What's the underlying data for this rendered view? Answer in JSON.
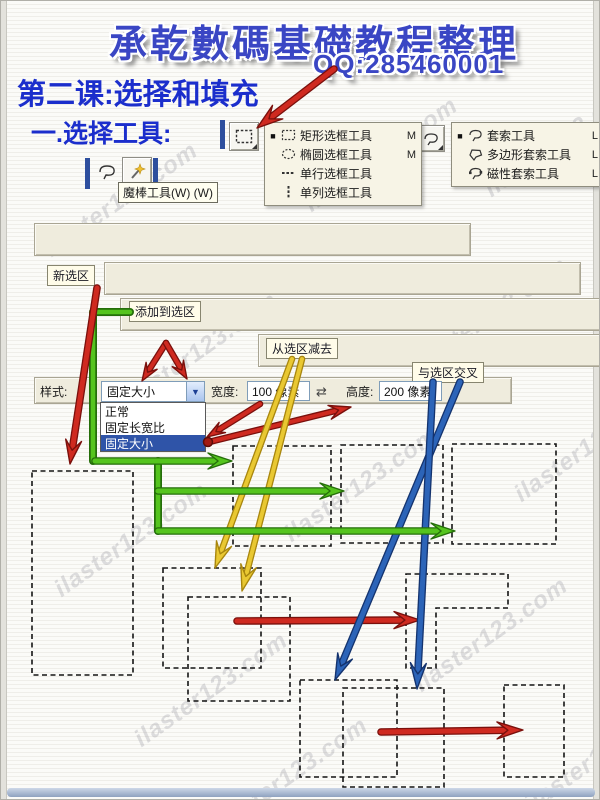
{
  "header": {
    "title": "承乾數碼基礎教程整理",
    "qq": "QQ:285460001"
  },
  "lesson": {
    "title": "第二课:选择和填充",
    "subtitle": "一.选择工具:"
  },
  "menus": {
    "marquee": {
      "items": [
        {
          "label": "矩形选框工具",
          "shortcut": "M",
          "icon": "rect-marquee-icon",
          "current": true
        },
        {
          "label": "椭圆选框工具",
          "shortcut": "M",
          "icon": "ellipse-marquee-icon",
          "current": false
        },
        {
          "label": "单行选框工具",
          "shortcut": "",
          "icon": "single-row-marquee-icon",
          "current": false
        },
        {
          "label": "单列选框工具",
          "shortcut": "",
          "icon": "single-column-marquee-icon",
          "current": false
        }
      ]
    },
    "lasso": {
      "items": [
        {
          "label": "套索工具",
          "shortcut": "L",
          "icon": "lasso-icon",
          "current": true
        },
        {
          "label": "多边形套索工具",
          "shortcut": "L",
          "icon": "polygon-lasso-icon",
          "current": false
        },
        {
          "label": "磁性套索工具",
          "shortcut": "L",
          "icon": "magnetic-lasso-icon",
          "current": false
        }
      ]
    }
  },
  "tooltip": {
    "magic_wand": "魔棒工具(W) (W)"
  },
  "option_bars": {
    "feather_label": "羽化:",
    "feather_value": "0 像素",
    "antialias_label": "消除锯齿",
    "style_label": "样式:",
    "style_value": "正常",
    "mode_names": [
      "new-selection",
      "add-to-selection",
      "subtract-from-selection",
      "intersect-selection"
    ],
    "bars": [
      {
        "active": 0
      },
      {
        "active": 1
      },
      {
        "active": 2
      },
      {
        "active": 3
      }
    ]
  },
  "callouts": [
    {
      "text": "新选区"
    },
    {
      "text": "添加到选区"
    },
    {
      "text": "从选区减去"
    },
    {
      "text": "与选区交叉"
    }
  ],
  "style_bar": {
    "label": "样式:",
    "value": "固定大小",
    "options": [
      "正常",
      "固定长宽比",
      "固定大小"
    ],
    "selected_option": "固定大小",
    "width_label": "宽度:",
    "width_value": "100 像素",
    "height_label": "高度:",
    "height_value": "200 像素"
  },
  "watermark": {
    "text": "ilaster123.com"
  },
  "colors": {
    "red": "#cf2a20",
    "red_dark": "#7a100c",
    "green": "#55c41e",
    "green_dark": "#256e0a",
    "yellow": "#e9c832",
    "yellow_dark": "#a8860e",
    "blue": "#2c64b8",
    "blue_dark": "#14336e",
    "title_blue": "#3a46c4",
    "lesson_blue": "#1b2ecc",
    "bar_bg": "#efecdd",
    "menu_bg": "#f7f4e6",
    "callout_bg": "#fffce9",
    "list_highlight": "#2f54a8"
  },
  "diagram": {
    "dashed_rects": [
      [
        31,
        470,
        101,
        204
      ],
      [
        232,
        445,
        98,
        100
      ],
      [
        340,
        444,
        102,
        98
      ],
      [
        451,
        443,
        104,
        100
      ],
      [
        162,
        567,
        98,
        100
      ],
      [
        187,
        596,
        102,
        104
      ],
      [
        299,
        679,
        97,
        97
      ],
      [
        342,
        687,
        101,
        99
      ],
      [
        503,
        684,
        60,
        92
      ]
    ],
    "l_shape": [
      [
        405,
        573
      ],
      [
        507,
        573
      ],
      [
        507,
        607
      ],
      [
        435,
        607
      ],
      [
        435,
        667
      ],
      [
        405,
        667
      ]
    ],
    "green_polylines": [
      [
        [
          129,
          311
        ],
        [
          92,
          311
        ],
        [
          92,
          460
        ]
      ],
      [
        [
          157,
          460
        ],
        [
          157,
          530
        ]
      ]
    ],
    "dot": [
      207,
      441
    ],
    "arrows": [
      {
        "color": "red",
        "from": [
          333,
          68
        ],
        "to": [
          256,
          127
        ],
        "w": 5,
        "head": 26,
        "wide": 17
      },
      {
        "color": "red",
        "from": [
          96,
          287
        ],
        "to": [
          69,
          463
        ],
        "w": 5,
        "head": 24,
        "wide": 16
      },
      {
        "color": "red",
        "from": [
          165,
          342
        ],
        "to": [
          141,
          380
        ],
        "w": 4,
        "head": 18,
        "wide": 13
      },
      {
        "color": "red",
        "from": [
          165,
          342
        ],
        "to": [
          186,
          378
        ],
        "w": 4,
        "head": 18,
        "wide": 13
      },
      {
        "color": "red",
        "from": [
          259,
          403
        ],
        "to": [
          206,
          436
        ],
        "w": 4,
        "head": 18,
        "wide": 12
      },
      {
        "color": "red",
        "from": [
          208,
          441
        ],
        "to": [
          350,
          406
        ],
        "w": 4,
        "head": 22,
        "wide": 14
      },
      {
        "color": "red",
        "from": [
          236,
          620
        ],
        "to": [
          419,
          619
        ],
        "w": 5,
        "head": 26,
        "wide": 17
      },
      {
        "color": "red",
        "from": [
          380,
          731
        ],
        "to": [
          522,
          729
        ],
        "w": 5,
        "head": 26,
        "wide": 17
      },
      {
        "color": "yellow",
        "from": [
          291,
          358
        ],
        "to": [
          214,
          567
        ],
        "w": 4,
        "head": 26,
        "wide": 16
      },
      {
        "color": "yellow",
        "from": [
          301,
          358
        ],
        "to": [
          241,
          590
        ],
        "w": 4,
        "head": 26,
        "wide": 16
      },
      {
        "color": "blue",
        "from": [
          459,
          381
        ],
        "to": [
          334,
          679
        ],
        "w": 5,
        "head": 26,
        "wide": 16
      },
      {
        "color": "blue",
        "from": [
          432,
          381
        ],
        "to": [
          416,
          688
        ],
        "w": 5,
        "head": 26,
        "wide": 16
      },
      {
        "color": "green",
        "from": [
          94,
          460
        ],
        "to": [
          231,
          460
        ],
        "w": 5,
        "head": 24,
        "wide": 16
      },
      {
        "color": "green",
        "from": [
          157,
          490
        ],
        "to": [
          343,
          490
        ],
        "w": 5,
        "head": 24,
        "wide": 16
      },
      {
        "color": "green",
        "from": [
          157,
          530
        ],
        "to": [
          454,
          530
        ],
        "w": 5,
        "head": 24,
        "wide": 16
      }
    ]
  }
}
